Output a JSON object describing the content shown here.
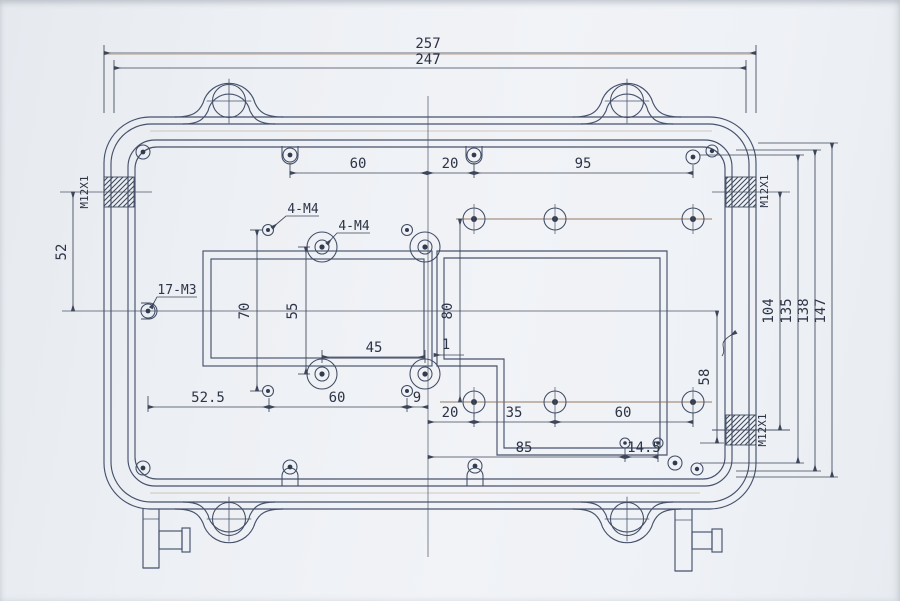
{
  "drawing": {
    "kind": "enclosure-dimension-drawing",
    "dims": {
      "d257": "257",
      "d247": "247",
      "top60": "60",
      "top20": "20",
      "top95": "95",
      "d52": "52",
      "d70": "70",
      "d55": "55",
      "d45": "45",
      "d1": "1",
      "d80": "80",
      "d52_5": "52.5",
      "mid60": "60",
      "d9": "9",
      "low20": "20",
      "low35": "35",
      "low60": "60",
      "d85": "85",
      "d14_5": "14.5",
      "d58": "58",
      "d104": "104",
      "d135": "135",
      "d138": "138",
      "d147": "147"
    },
    "labels": {
      "pattern_a": "4-M4",
      "pattern_b": "4-M4",
      "perimeter": "17-M3",
      "gland_left": "M12X1",
      "gland_top_right": "M12X1",
      "gland_bottom_right": "M12X1"
    }
  }
}
